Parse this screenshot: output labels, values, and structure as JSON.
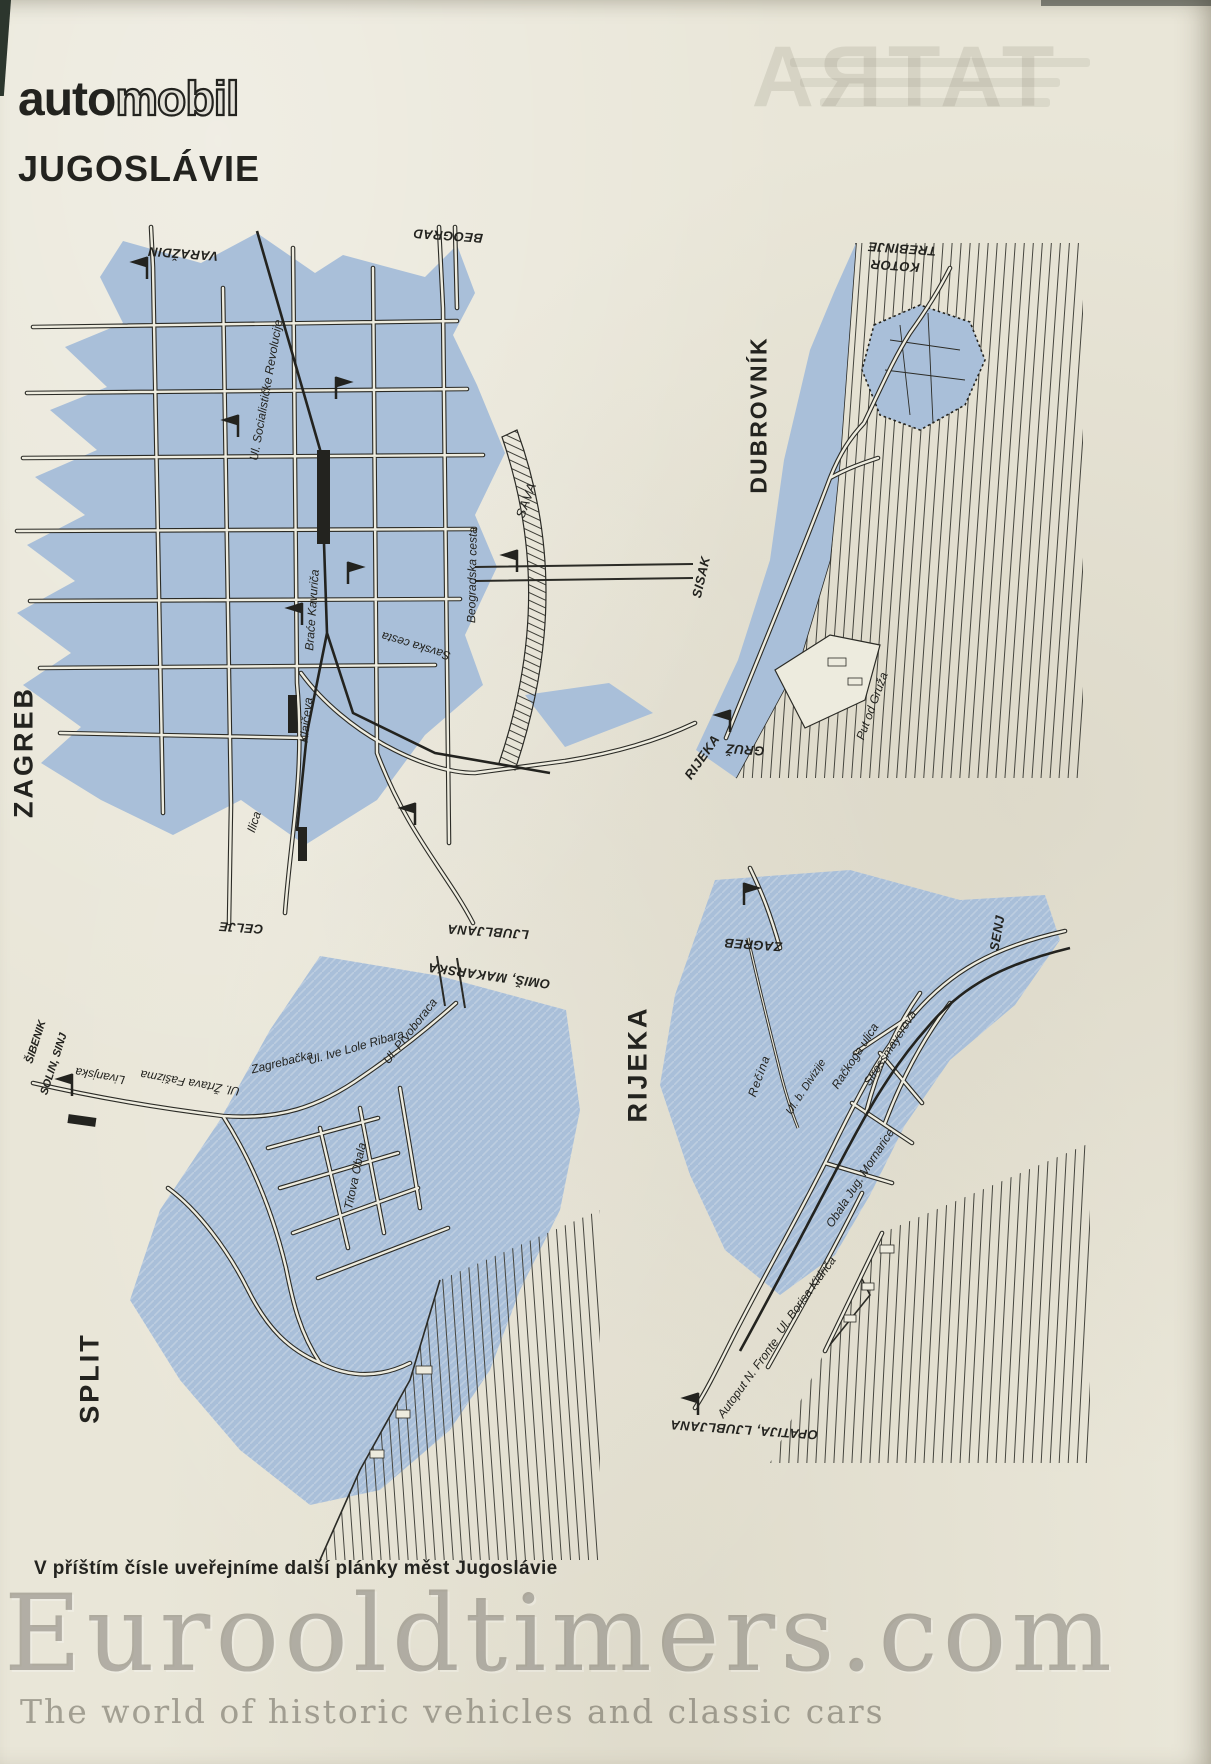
{
  "header": {
    "logo_auto": "auto",
    "logo_mobil": "mobil",
    "title": "JUGOSLÁVIE"
  },
  "footer": {
    "caption": "V příštím čísle uveřejníme další plánky měst Jugoslávie"
  },
  "watermark": {
    "main": "Eurooldtimers.com",
    "sub": "The world of historic vehicles and classic cars"
  },
  "bleedthrough": {
    "text": "TATRA"
  },
  "colors": {
    "paper": "#e9e6d8",
    "map_blue": "#a9bfd9",
    "ink": "#2b2b26"
  },
  "maps": {
    "zagreb": {
      "city": "ZAGREB",
      "out": {
        "varazdin": "VARAŽDIN",
        "beograd": "BEOGRAD",
        "sisak": "SISAK",
        "rijeka": "RIJEKA",
        "ljubljana": "LJUBLJANA",
        "celje": "CELJE"
      },
      "streets": {
        "socialisticke": "Ul. Socialističke Revolucije",
        "kavurica": "Braće Kavuriča",
        "klaiceva": "Klaičeva",
        "beogradska": "Beogradska cesta",
        "savska": "Savska cesta",
        "ilica": "Ilica"
      },
      "river": "SAVA"
    },
    "dubrovnik": {
      "city": "DUBROVNÍK",
      "out": {
        "trebinje": "TREBINJE",
        "kotor": "KOTOR",
        "gruz": "GRUŽ"
      },
      "streets": {
        "put_od_gruza": "Put od Gruža"
      }
    },
    "split": {
      "city": "SPLIT",
      "out": {
        "sibenik": "ŠIBENIK",
        "solin_sinj": "SOLIN, SINJ",
        "omis_makarska": "OMIŠ, MAKARSKA"
      },
      "streets": {
        "livanjska": "Livanjska",
        "zrtava": "Ul. Žrtava Fašizma",
        "zagrebacka": "Zagrebačka",
        "ive_lole": "Ul. Ive Lole Ribara",
        "prvoboraca": "Ul. Prvoboraca",
        "obala": "Titova Obala"
      }
    },
    "rijeka": {
      "city": "RIJEKA",
      "out": {
        "zagreb": "ZAGREB",
        "senj": "SENJ",
        "opatija_ljubljana": "OPATIJA, LJUBLJANA"
      },
      "streets": {
        "strossmayerova": "Strossmayerova",
        "rackoga": "Račkoga ulica",
        "divizije": "Ul. b. Divizije",
        "mornarice": "Obala Jug. Mornarice",
        "autoput": "Autoput N. Fronte",
        "kidrica": "Ul. Borisa Kidriča"
      },
      "river": "Rečina"
    }
  }
}
